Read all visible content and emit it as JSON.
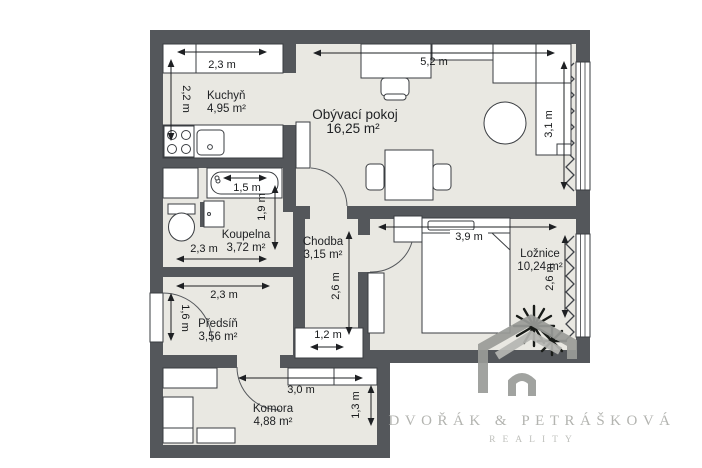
{
  "rooms": {
    "kitchen": {
      "name": "Kuchyň",
      "area": "4,95 m²"
    },
    "living": {
      "name": "Obývací pokoj",
      "area": "16,25 m²"
    },
    "bathroom": {
      "name": "Koupelna",
      "area": "3,72 m²"
    },
    "hallway": {
      "name": "Chodba",
      "area": "3,15 m²"
    },
    "bedroom": {
      "name": "Ložnice",
      "area": "10,24 m²"
    },
    "entry": {
      "name": "Předsíň",
      "area": "3,56 m²"
    },
    "storage": {
      "name": "Komora",
      "area": "4,88 m²"
    }
  },
  "dims": {
    "kitchen_width": "2,3 m",
    "kitchen_depth": "2,2 m",
    "living_width": "5,2 m",
    "living_depth": "3,1 m",
    "bathtub_width": "1,5 m",
    "bathroom_depth": "1,9 m",
    "bathroom_width": "2,3 m",
    "entry_width": "2,3 m",
    "entry_depth": "1,6 m",
    "hallway_depth": "2,6 m",
    "hallway_closet_width": "1,2 m",
    "bedroom_width": "3,9 m",
    "bedroom_depth": "2,6 m",
    "storage_width": "3,0 m",
    "storage_depth": "1,3 m"
  },
  "branding": {
    "company": "DVOŘÁK & PETRÁŠKOVÁ",
    "tagline": "REALITY"
  },
  "colors": {
    "wall": "#54575b",
    "floor": "#e9e8e2",
    "furniture_outline": "#3a3d41",
    "dimension_text": "#17191b",
    "logo_gray": "#9a9c98",
    "logo_text": "#b3b4b0"
  }
}
